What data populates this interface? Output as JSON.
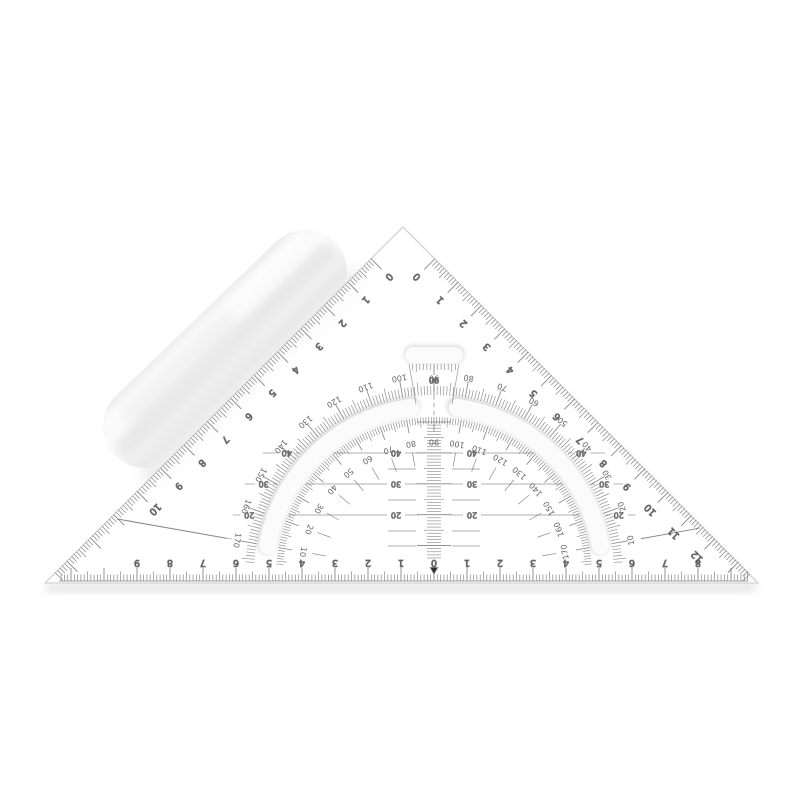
{
  "scene": {
    "description": "transparent 45-degree drafting set square with inverted protractor and translucent packaging tube",
    "background": "#ffffff",
    "ink_color": "#5a5a5a",
    "label_color": "#4e4e4e",
    "edge_color": "#d3d3d3",
    "slot_shadow_color": "#d7d7d7",
    "slot_fill_color": "#fbfbfb",
    "shadow_color": "#c9c9c9",
    "marker_color": "#2b2b2b"
  },
  "left_edge_scale": {
    "labels": [
      "0",
      "1",
      "2",
      "3",
      "4",
      "5",
      "6",
      "7",
      "8",
      "9",
      "10"
    ]
  },
  "right_edge_scale": {
    "labels": [
      "0",
      "1",
      "2",
      "3",
      "4",
      "5",
      "6",
      "7",
      "8",
      "9",
      "10",
      "11",
      "12"
    ]
  },
  "bottom_scale": {
    "left_labels": [
      "1",
      "2",
      "3",
      "4",
      "5",
      "6",
      "7",
      "8",
      "9"
    ],
    "zero": "0",
    "right_labels": [
      "1",
      "2",
      "3",
      "4",
      "5",
      "6",
      "7",
      "8"
    ],
    "zero_marker": "▼"
  },
  "protractor": {
    "outer_top": "90",
    "outer_left": [
      "100",
      "110",
      "120",
      "130",
      "140",
      "150",
      "160",
      "170"
    ],
    "outer_right": [
      "80",
      "70",
      "60",
      "50",
      "40",
      "30",
      "20",
      "10"
    ],
    "inner_top": "90",
    "inner_left": [
      "80",
      "70",
      "60",
      "50",
      "40",
      "30",
      "20",
      "10"
    ],
    "inner_right": [
      "100",
      "110",
      "120",
      "130",
      "140",
      "150",
      "160",
      "170"
    ],
    "neck_label": "90",
    "grid_row_labels": [
      "40",
      "30",
      "20"
    ]
  }
}
